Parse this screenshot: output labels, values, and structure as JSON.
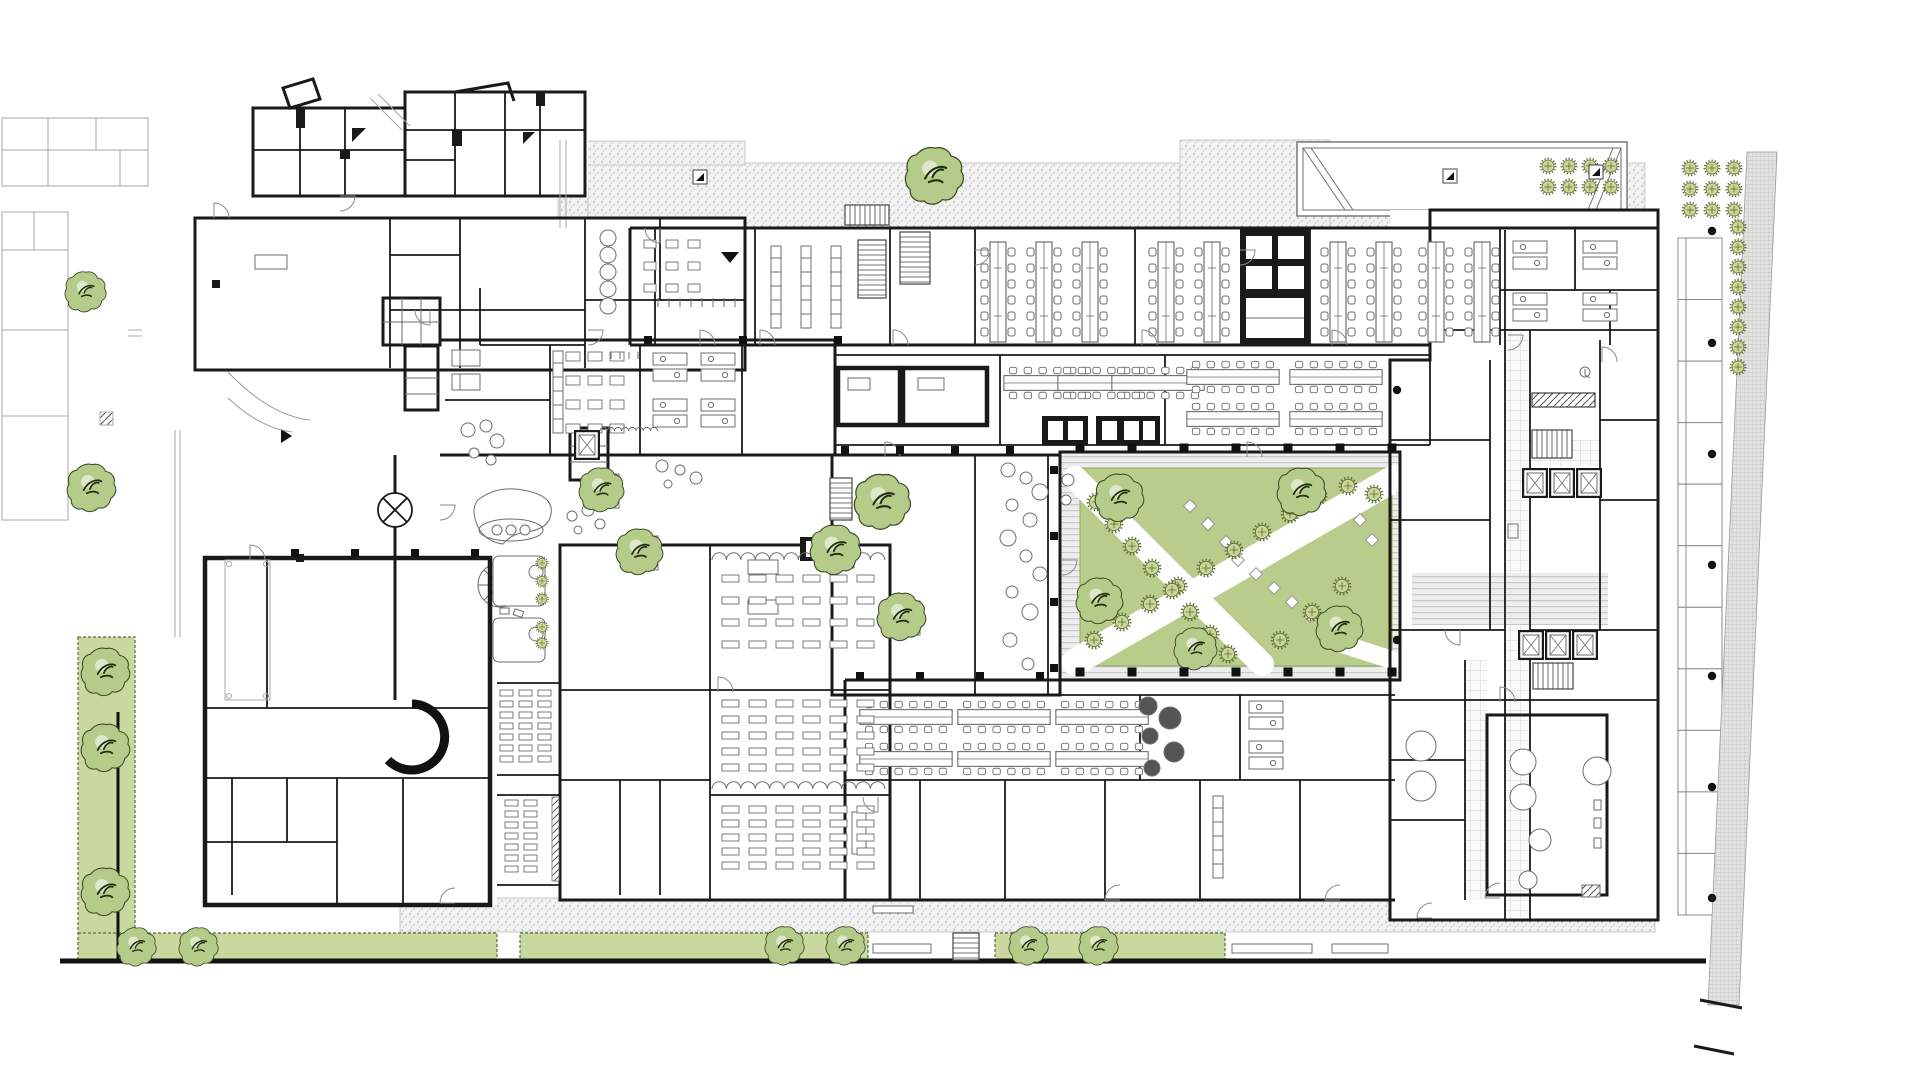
{
  "title": "architectural-ground-floor-plan",
  "colors": {
    "wall": "#1a1a1a",
    "line": "#6e6e6e",
    "light": "#a8a8a8",
    "green_strip": "#c9d89f",
    "lawn": "#b9cc8c",
    "tree_fill": "#b4cb89",
    "tree_edge": "#3c4a22",
    "tree_detail": "#23301196",
    "plant_dot": "#c8d794",
    "plant_dot_edge": "#5b6b35",
    "deck_bg": "#ededed",
    "deck_line": "#c9c9c9",
    "stipple_bg": "#f2f2f2",
    "stipple_dot": "#b3b3b3",
    "tile_line": "#cccccc",
    "dark_equip": "#555555"
  },
  "plan": {
    "site": {
      "green_rects": [
        {
          "x": 78,
          "y": 637,
          "w": 57,
          "h": 322
        },
        {
          "x": 78,
          "y": 933,
          "w": 419,
          "h": 27
        },
        {
          "x": 520,
          "y": 933,
          "w": 348,
          "h": 27
        },
        {
          "x": 995,
          "y": 933,
          "w": 230,
          "h": 27
        }
      ],
      "stipple_rects": [
        {
          "x": 563,
          "y": 163,
          "w": 1082,
          "h": 64
        },
        {
          "x": 1180,
          "y": 140,
          "w": 150,
          "h": 88
        },
        {
          "x": 585,
          "y": 141,
          "w": 160,
          "h": 24
        },
        {
          "x": 558,
          "y": 185,
          "w": 30,
          "h": 43
        },
        {
          "x": 400,
          "y": 898,
          "w": 1255,
          "h": 34
        }
      ],
      "benches": [
        {
          "x": 873,
          "y": 944,
          "w": 58,
          "h": 9
        },
        {
          "x": 1232,
          "y": 944,
          "w": 80,
          "h": 9
        },
        {
          "x": 873,
          "y": 906,
          "w": 40,
          "h": 7
        },
        {
          "x": 1332,
          "y": 944,
          "w": 56,
          "h": 9
        }
      ],
      "bays": {
        "x": 1678,
        "y": 238,
        "w": 44,
        "h": 677,
        "n": 11
      },
      "hatch_poly": "1747,152 1777,152 1739,1005 1708,1005",
      "columns_squares": [
        {
          "x0": 1080,
          "y0": 448,
          "dx": 52,
          "dy": 0,
          "n": 7,
          "s": 9
        },
        {
          "x0": 1080,
          "y0": 672,
          "dx": 52,
          "dy": 0,
          "n": 7,
          "s": 9
        },
        {
          "x0": 1054,
          "y0": 470,
          "dx": 0,
          "dy": 66,
          "n": 4,
          "s": 8
        },
        {
          "x0": 845,
          "y0": 450,
          "dx": 55,
          "dy": 0,
          "n": 4,
          "s": 8
        },
        {
          "x0": 860,
          "y0": 676,
          "dx": 60,
          "dy": 0,
          "n": 4,
          "s": 8
        },
        {
          "x0": 295,
          "y0": 553,
          "dx": 60,
          "dy": 0,
          "n": 4,
          "s": 8
        },
        {
          "x0": 648,
          "y0": 340,
          "dx": 95,
          "dy": 0,
          "n": 3,
          "s": 8
        }
      ],
      "columns_dots": [
        [
          1712,
          231
        ],
        [
          1712,
          343
        ],
        [
          1712,
          454
        ],
        [
          1712,
          565
        ],
        [
          1712,
          676
        ],
        [
          1712,
          787
        ],
        [
          1712,
          898
        ],
        [
          1397,
          390
        ],
        [
          1397,
          640
        ]
      ],
      "marker_squares": [
        [
          700,
          177
        ],
        [
          1450,
          176
        ],
        [
          1596,
          172
        ]
      ],
      "arrow_down": {
        "x": 730,
        "y": 252
      },
      "arrow_right": {
        "x": 281,
        "y": 436
      }
    },
    "vegetation": {
      "trees_big": [
        {
          "x": 106,
          "y": 672,
          "r": 26
        },
        {
          "x": 106,
          "y": 748,
          "r": 26
        },
        {
          "x": 106,
          "y": 892,
          "r": 26
        },
        {
          "x": 137,
          "y": 947,
          "r": 21
        },
        {
          "x": 199,
          "y": 947,
          "r": 21
        },
        {
          "x": 785,
          "y": 946,
          "r": 21
        },
        {
          "x": 846,
          "y": 946,
          "r": 21
        },
        {
          "x": 1029,
          "y": 946,
          "r": 21
        },
        {
          "x": 1099,
          "y": 946,
          "r": 21
        },
        {
          "x": 935,
          "y": 176,
          "r": 31
        },
        {
          "x": 86,
          "y": 292,
          "r": 22
        },
        {
          "x": 92,
          "y": 488,
          "r": 26
        },
        {
          "x": 883,
          "y": 502,
          "r": 30
        },
        {
          "x": 836,
          "y": 550,
          "r": 27
        },
        {
          "x": 902,
          "y": 617,
          "r": 26
        },
        {
          "x": 602,
          "y": 490,
          "r": 24
        },
        {
          "x": 640,
          "y": 552,
          "r": 25
        },
        {
          "x": 1120,
          "y": 498,
          "r": 26
        },
        {
          "x": 1100,
          "y": 601,
          "r": 25
        },
        {
          "x": 1196,
          "y": 649,
          "r": 23
        },
        {
          "x": 1302,
          "y": 492,
          "r": 26
        },
        {
          "x": 1340,
          "y": 629,
          "r": 25
        }
      ],
      "planter_squares": [
        [
          866,
          486
        ],
        [
          820,
          534
        ],
        [
          886,
          601
        ],
        [
          585,
          474
        ],
        [
          624,
          536
        ]
      ],
      "trees_small": [
        [
          1094,
          640
        ],
        [
          1122,
          622
        ],
        [
          1150,
          604
        ],
        [
          1178,
          586
        ],
        [
          1206,
          568
        ],
        [
          1234,
          550
        ],
        [
          1262,
          532
        ],
        [
          1290,
          514
        ],
        [
          1318,
          496
        ],
        [
          1348,
          486
        ],
        [
          1374,
          494
        ],
        [
          1096,
          502
        ],
        [
          1114,
          524
        ],
        [
          1132,
          546
        ],
        [
          1152,
          568
        ],
        [
          1172,
          590
        ],
        [
          1190,
          612
        ],
        [
          1210,
          634
        ],
        [
          1228,
          654
        ],
        [
          1280,
          640
        ],
        [
          1312,
          612
        ],
        [
          1342,
          586
        ]
      ],
      "plant_grids": [
        {
          "x0": 1548,
          "y0": 166,
          "dx": 21,
          "dy": 21,
          "cols": 4,
          "rows": 2
        },
        {
          "x0": 1690,
          "y0": 168,
          "dx": 22,
          "dy": 21,
          "cols": 3,
          "rows": 3
        }
      ],
      "plant_col": {
        "x": 1738,
        "y0": 227,
        "dy": 20,
        "n": 8
      },
      "plant_small": [
        [
          542,
          563
        ],
        [
          542,
          581
        ],
        [
          542,
          599
        ],
        [
          542,
          627
        ],
        [
          542,
          643
        ]
      ]
    },
    "furniture": {
      "bench_v": [
        [
          980,
          240
        ],
        [
          1026,
          240
        ],
        [
          1072,
          240
        ],
        [
          1148,
          240
        ],
        [
          1194,
          240
        ],
        [
          1320,
          240
        ],
        [
          1366,
          240
        ],
        [
          1418,
          240
        ],
        [
          1464,
          240
        ]
      ],
      "bench_h": [
        [
          1002,
          366
        ],
        [
          1056,
          366
        ],
        [
          1110,
          366
        ],
        [
          1185,
          360
        ],
        [
          1288,
          360
        ],
        [
          1185,
          402
        ],
        [
          1288,
          402
        ],
        [
          858,
          700
        ],
        [
          956,
          700
        ],
        [
          1054,
          700
        ],
        [
          858,
          742
        ],
        [
          956,
          742
        ],
        [
          1054,
          742
        ]
      ],
      "desk_pods": [
        [
          652,
          352
        ],
        [
          700,
          352
        ],
        [
          652,
          398
        ],
        [
          700,
          398
        ],
        [
          1512,
          240
        ],
        [
          1582,
          240
        ],
        [
          1512,
          292
        ],
        [
          1582,
          292
        ],
        [
          1248,
          700
        ],
        [
          1248,
          740
        ]
      ],
      "table_grids": [
        {
          "x0": 722,
          "y0": 575,
          "cols": 6,
          "dx": 27,
          "rows": 4,
          "dy": 22,
          "w": 17,
          "h": 7
        },
        {
          "x0": 722,
          "y0": 700,
          "cols": 6,
          "dx": 27,
          "rows": 5,
          "dy": 16,
          "w": 17,
          "h": 7
        },
        {
          "x0": 722,
          "y0": 806,
          "cols": 6,
          "dx": 27,
          "rows": 5,
          "dy": 14,
          "w": 17,
          "h": 7
        },
        {
          "x0": 500,
          "y0": 690,
          "cols": 3,
          "dx": 19,
          "rows": 7,
          "dy": 11,
          "w": 13,
          "h": 6
        },
        {
          "x0": 505,
          "y0": 800,
          "cols": 2,
          "dx": 19,
          "rows": 7,
          "dy": 11,
          "w": 13,
          "h": 6
        },
        {
          "x0": 566,
          "y0": 352,
          "cols": 3,
          "dx": 22,
          "rows": 4,
          "dy": 24,
          "w": 14,
          "h": 9
        },
        {
          "x0": 644,
          "y0": 240,
          "cols": 3,
          "dx": 22,
          "rows": 3,
          "dy": 22,
          "w": 12,
          "h": 8
        }
      ],
      "shelves": [
        [
          770,
          245
        ],
        [
          800,
          245
        ],
        [
          830,
          245
        ],
        [
          552,
          350
        ],
        [
          1212,
          795
        ]
      ],
      "stairs": [
        {
          "x": 858,
          "y": 240,
          "w": 28,
          "h": 58
        },
        {
          "x": 900,
          "y": 232,
          "w": 30,
          "h": 52
        },
        {
          "x": 830,
          "y": 478,
          "w": 22,
          "h": 42
        },
        {
          "x": 1532,
          "y": 430,
          "w": 40,
          "h": 28
        },
        {
          "x": 1533,
          "y": 663,
          "w": 40,
          "h": 26
        },
        {
          "x": 953,
          "y": 933,
          "w": 26,
          "h": 27
        },
        {
          "x": 845,
          "y": 205,
          "w": 44,
          "h": 20
        }
      ],
      "elevators": [
        [
          1522,
          468
        ],
        [
          1549,
          468
        ],
        [
          1576,
          468
        ],
        [
          1518,
          630
        ],
        [
          1545,
          630
        ],
        [
          1572,
          630
        ],
        [
          574,
          430
        ]
      ],
      "beds": [
        [
          452,
          350
        ],
        [
          452,
          374
        ]
      ],
      "circles": [
        [
          468,
          430,
          7,
          0
        ],
        [
          486,
          426,
          6,
          0
        ],
        [
          497,
          441,
          7,
          0
        ],
        [
          474,
          453,
          5,
          0
        ],
        [
          491,
          460,
          5,
          0
        ],
        [
          572,
          516,
          5,
          0
        ],
        [
          588,
          510,
          6,
          0
        ],
        [
          600,
          524,
          5,
          0
        ],
        [
          578,
          530,
          4,
          0
        ],
        [
          662,
          466,
          6,
          0
        ],
        [
          680,
          470,
          5,
          0
        ],
        [
          696,
          478,
          6,
          0
        ],
        [
          668,
          484,
          4,
          0
        ],
        [
          608,
          238,
          8,
          0
        ],
        [
          608,
          255,
          8,
          0
        ],
        [
          608,
          272,
          8,
          0
        ],
        [
          608,
          289,
          8,
          0
        ],
        [
          608,
          306,
          8,
          0
        ],
        [
          1008,
          470,
          7,
          0
        ],
        [
          1026,
          478,
          6,
          0
        ],
        [
          1040,
          492,
          8,
          0
        ],
        [
          1012,
          505,
          6,
          0
        ],
        [
          1030,
          520,
          7,
          0
        ],
        [
          1008,
          538,
          8,
          0
        ],
        [
          1026,
          556,
          6,
          0
        ],
        [
          1040,
          574,
          7,
          0
        ],
        [
          1012,
          592,
          6,
          0
        ],
        [
          1030,
          612,
          8,
          0
        ],
        [
          1010,
          640,
          7,
          0
        ],
        [
          1028,
          664,
          6,
          0
        ],
        [
          1523,
          762,
          13,
          0
        ],
        [
          1523,
          797,
          13,
          0
        ],
        [
          1597,
          771,
          14,
          0
        ],
        [
          1540,
          840,
          11,
          0
        ],
        [
          1528,
          880,
          9,
          0
        ],
        [
          1421,
          746,
          15,
          0
        ],
        [
          1421,
          786,
          15,
          0
        ],
        [
          536,
          572,
          7,
          0
        ],
        [
          536,
          634,
          7,
          0
        ],
        [
          1148,
          706,
          9,
          1
        ],
        [
          1170,
          718,
          11,
          1
        ],
        [
          1150,
          736,
          8,
          1
        ],
        [
          1174,
          752,
          10,
          1
        ],
        [
          1152,
          768,
          8,
          1
        ],
        [
          497,
          530,
          5,
          0
        ],
        [
          511,
          530,
          5,
          0
        ],
        [
          525,
          530,
          5,
          0
        ],
        [
          1068,
          480,
          6,
          0
        ],
        [
          1066,
          500,
          5,
          0
        ]
      ],
      "pavers": [
        [
          1238,
          560
        ],
        [
          1256,
          574
        ],
        [
          1274,
          588
        ],
        [
          1292,
          602
        ],
        [
          1310,
          616
        ],
        [
          1226,
          542
        ],
        [
          1208,
          524
        ],
        [
          1190,
          506
        ],
        [
          1360,
          520
        ],
        [
          1372,
          540
        ]
      ],
      "door_arcs": [
        [
          214,
          218,
          0
        ],
        [
          340,
          196,
          90
        ],
        [
          430,
          310,
          180
        ],
        [
          588,
          330,
          90
        ],
        [
          700,
          345,
          0
        ],
        [
          760,
          345,
          0
        ],
        [
          893,
          345,
          0
        ],
        [
          1142,
          345,
          0
        ],
        [
          1332,
          345,
          0
        ],
        [
          1508,
          335,
          90
        ],
        [
          1602,
          362,
          0
        ],
        [
          1460,
          630,
          180
        ],
        [
          1500,
          702,
          0
        ],
        [
          885,
          457,
          0
        ],
        [
          1062,
          560,
          90
        ],
        [
          440,
          505,
          90
        ],
        [
          718,
          692,
          0
        ],
        [
          878,
          797,
          180
        ],
        [
          250,
          560,
          0
        ],
        [
          455,
          903,
          270
        ],
        [
          1432,
          918,
          270
        ],
        [
          1247,
          457,
          0
        ],
        [
          1120,
          900,
          270
        ],
        [
          1340,
          900,
          270
        ],
        [
          1500,
          898,
          270
        ],
        [
          660,
          228,
          180
        ],
        [
          975,
          250,
          90
        ],
        [
          1240,
          250,
          90
        ]
      ],
      "scallops": [
        {
          "x": 600,
          "y": 431,
          "n": 8,
          "r": 3.6
        },
        {
          "x": 712,
          "y": 789,
          "n": 12,
          "r": 7.2
        },
        {
          "x": 712,
          "y": 560,
          "n": 12,
          "r": 7.2
        }
      ],
      "ticks": [
        {
          "x0": 658,
          "y0": 298,
          "dx": 11,
          "n": 8,
          "len": 9
        },
        {
          "x0": 602,
          "y0": 352,
          "dx": 9,
          "n": 5,
          "len": 7
        }
      ]
    }
  }
}
